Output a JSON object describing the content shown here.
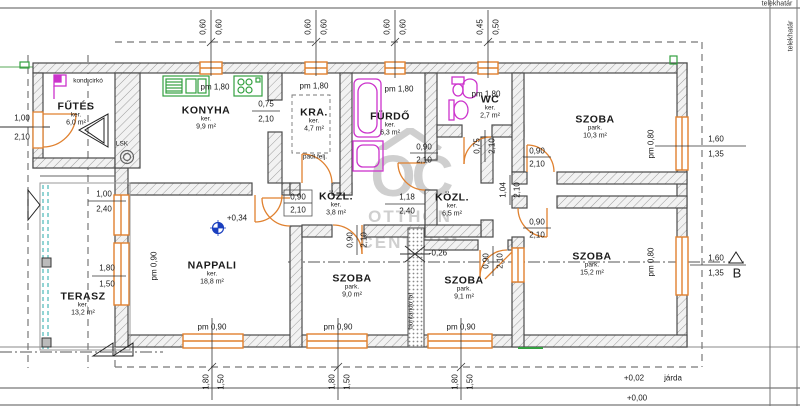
{
  "boundary": {
    "telekhatar_top": "telekhatár",
    "telekhatar_right": "telekhatár"
  },
  "watermark": {
    "logo": "OC",
    "line1": "OTTHON",
    "line2": "CENTRUM"
  },
  "rooms": [
    {
      "name": "FŰTÉS",
      "kind": "ker.",
      "area": "6,0 m²",
      "x": 76,
      "y": 114
    },
    {
      "name": "KONYHA",
      "kind": "ker.",
      "area": "9,9 m²",
      "x": 206,
      "y": 118
    },
    {
      "name": "KRA.",
      "kind": "ker.",
      "area": "4,7 m²",
      "x": 314,
      "y": 120
    },
    {
      "name": "FÜRDŐ",
      "kind": "ker.",
      "area": "6,3 m²",
      "x": 390,
      "y": 124
    },
    {
      "name": "WC",
      "kind": "ker.",
      "area": "2,7 m²",
      "x": 490,
      "y": 107
    },
    {
      "name": "SZOBA",
      "kind": "park.",
      "area": "10,3 m²",
      "x": 595,
      "y": 127
    },
    {
      "name": "KÖZL.",
      "kind": "ker.",
      "area": "3,8 m²",
      "x": 336,
      "y": 204
    },
    {
      "name": "KÖZL.",
      "kind": "ker.",
      "area": "6,5 m²",
      "x": 452,
      "y": 205
    },
    {
      "name": "NAPPALI",
      "kind": "ker.",
      "area": "18,8 m²",
      "x": 212,
      "y": 273
    },
    {
      "name": "TERASZ",
      "kind": "ker.",
      "area": "13,2 m²",
      "x": 83,
      "y": 304
    },
    {
      "name": "SZOBA",
      "kind": "park.",
      "area": "9,0 m²",
      "x": 352,
      "y": 286
    },
    {
      "name": "SZOBA",
      "kind": "park.",
      "area": "9,1 m²",
      "x": 464,
      "y": 288
    },
    {
      "name": "SZOBA",
      "kind": "park.",
      "area": "15,2 m²",
      "x": 592,
      "y": 264
    }
  ],
  "dims": [
    {
      "text": "0,60",
      "x": 203,
      "y": 27,
      "r": 1
    },
    {
      "text": "0,60",
      "x": 219,
      "y": 27,
      "r": 1
    },
    {
      "text": "0,60",
      "x": 308,
      "y": 27,
      "r": 1
    },
    {
      "text": "0,60",
      "x": 324,
      "y": 27,
      "r": 1
    },
    {
      "text": "0,60",
      "x": 387,
      "y": 27,
      "r": 1
    },
    {
      "text": "0,60",
      "x": 403,
      "y": 27,
      "r": 1
    },
    {
      "text": "0,45",
      "x": 480,
      "y": 27,
      "r": 1
    },
    {
      "text": "0,50",
      "x": 496,
      "y": 27,
      "r": 1
    },
    {
      "text": "1,00",
      "x": 22,
      "y": 118
    },
    {
      "text": "2,10",
      "x": 22,
      "y": 137
    },
    {
      "text": "1,00",
      "x": 104,
      "y": 194
    },
    {
      "text": "2,40",
      "x": 104,
      "y": 209
    },
    {
      "text": "1,80",
      "x": 107,
      "y": 268
    },
    {
      "text": "1,50",
      "x": 107,
      "y": 284
    },
    {
      "text": "pm 1,80",
      "x": 215,
      "y": 87
    },
    {
      "text": "pm 1,80",
      "x": 314,
      "y": 86
    },
    {
      "text": "pm 1,80",
      "x": 399,
      "y": 89
    },
    {
      "text": "pm 1,80",
      "x": 486,
      "y": 94
    },
    {
      "text": "pm 0,90",
      "x": 212,
      "y": 327
    },
    {
      "text": "pm 0,90",
      "x": 338,
      "y": 327
    },
    {
      "text": "pm 0,90",
      "x": 461,
      "y": 327
    },
    {
      "text": "pm 0,90",
      "x": 154,
      "y": 266,
      "r": 1
    },
    {
      "text": "pm 0,80",
      "x": 651,
      "y": 144,
      "r": 1
    },
    {
      "text": "pm 0,80",
      "x": 651,
      "y": 262,
      "r": 1
    },
    {
      "text": "0,75",
      "x": 266,
      "y": 104
    },
    {
      "text": "2,10",
      "x": 266,
      "y": 119
    },
    {
      "text": "0,90",
      "x": 298,
      "y": 197
    },
    {
      "text": "2,10",
      "x": 298,
      "y": 210
    },
    {
      "text": "1,18",
      "x": 407,
      "y": 197
    },
    {
      "text": "2,40",
      "x": 407,
      "y": 211
    },
    {
      "text": "0,90",
      "x": 424,
      "y": 147
    },
    {
      "text": "2,10",
      "x": 424,
      "y": 160
    },
    {
      "text": "0,75",
      "x": 477,
      "y": 146,
      "r": 1
    },
    {
      "text": "2,10",
      "x": 492,
      "y": 146,
      "r": 1
    },
    {
      "text": "1,04",
      "x": 503,
      "y": 190,
      "r": 1
    },
    {
      "text": "2,10",
      "x": 517,
      "y": 190,
      "r": 1
    },
    {
      "text": "0,90",
      "x": 350,
      "y": 240,
      "r": 1
    },
    {
      "text": "2,10",
      "x": 364,
      "y": 240,
      "r": 1
    },
    {
      "text": "0,90",
      "x": 537,
      "y": 151
    },
    {
      "text": "2,10",
      "x": 537,
      "y": 164
    },
    {
      "text": "0,90",
      "x": 537,
      "y": 222
    },
    {
      "text": "2,10",
      "x": 537,
      "y": 235
    },
    {
      "text": "0,90",
      "x": 486,
      "y": 261,
      "r": 1
    },
    {
      "text": "2,10",
      "x": 500,
      "y": 261,
      "r": 1
    },
    {
      "text": "1,60",
      "x": 716,
      "y": 139
    },
    {
      "text": "1,35",
      "x": 716,
      "y": 154
    },
    {
      "text": "1,60",
      "x": 716,
      "y": 258
    },
    {
      "text": "1,35",
      "x": 716,
      "y": 273
    },
    {
      "text": "1,80",
      "x": 206,
      "y": 382,
      "r": 1
    },
    {
      "text": "1,50",
      "x": 221,
      "y": 382,
      "r": 1
    },
    {
      "text": "1,80",
      "x": 332,
      "y": 382,
      "r": 1
    },
    {
      "text": "1,50",
      "x": 347,
      "y": 382,
      "r": 1
    },
    {
      "text": "1,80",
      "x": 455,
      "y": 382,
      "r": 1
    },
    {
      "text": "1,50",
      "x": 470,
      "y": 382,
      "r": 1
    }
  ],
  "levels": [
    {
      "text": "+0,34",
      "x": 237,
      "y": 218
    },
    {
      "text": "-0,26",
      "x": 438,
      "y": 253
    },
    {
      "text": "+0,02",
      "x": 634,
      "y": 378
    },
    {
      "text": "járda",
      "x": 673,
      "y": 378
    },
    {
      "text": "+0,00",
      "x": 637,
      "y": 398
    }
  ],
  "notes": [
    {
      "text": "kond.cirkó",
      "x": 88,
      "y": 81
    },
    {
      "text": "LSK",
      "x": 122,
      "y": 144
    },
    {
      "text": "padl.felj.",
      "x": 315,
      "y": 157
    },
    {
      "text": "bontandó fal",
      "x": 411,
      "y": 311,
      "r": 1
    },
    {
      "text": "B",
      "x": 737,
      "y": 273,
      "cls": "big"
    }
  ]
}
